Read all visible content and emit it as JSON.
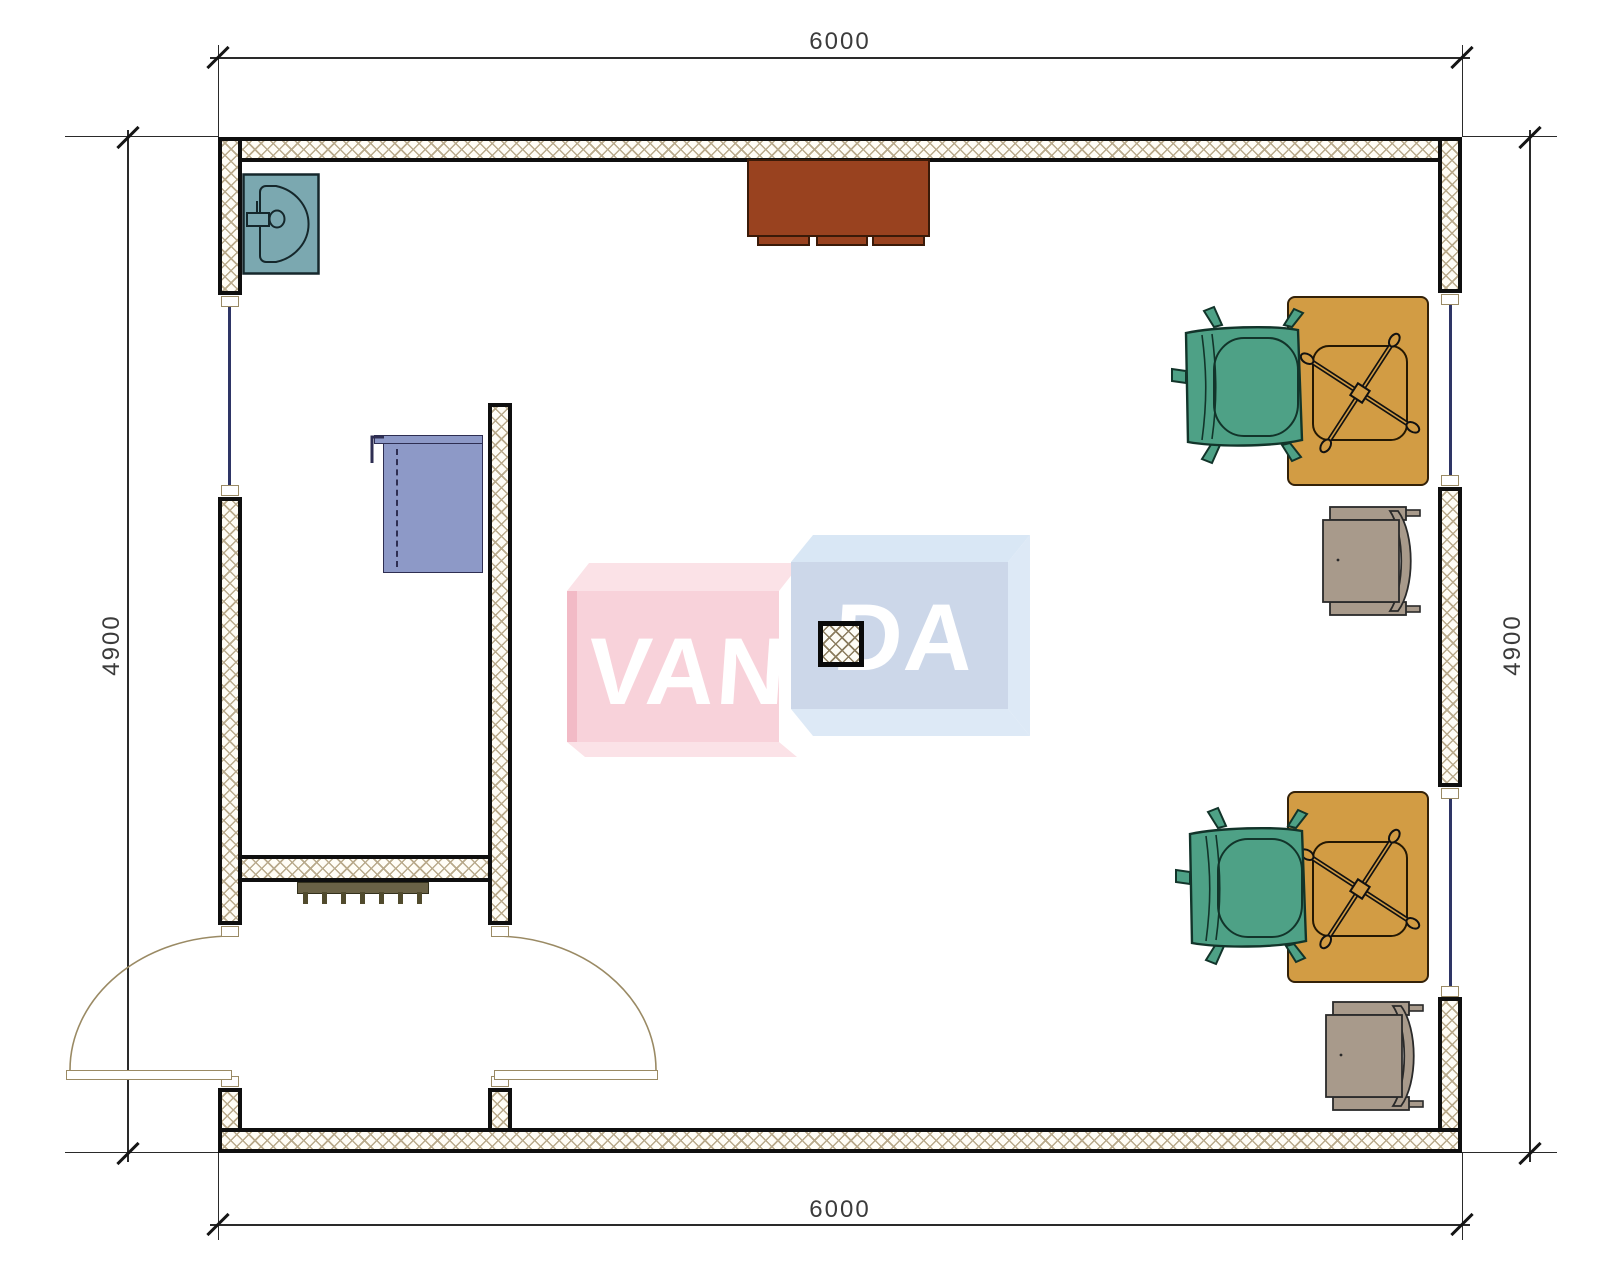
{
  "drawing": {
    "dimensions": {
      "top": "6000",
      "bottom": "6000",
      "left": "4900",
      "right": "4900"
    },
    "watermark": {
      "left": "VAN",
      "right": "DA"
    }
  },
  "colors": {
    "wall_line": "#0f0f0f",
    "wall_hatch": "#b9aa8c",
    "window": "#2e3566",
    "door_arc": "#9a8a64",
    "dim_text": "#3b3b3b",
    "sink": "#7ba8b0",
    "cabinet": "#99421f",
    "counter": "#8d99c7",
    "desk": "#d29c44",
    "armchair": "#4ea186",
    "side_chair": "#a89a8b",
    "radiator": "#6a6246",
    "logo_pink": "#f8d2da",
    "logo_pink_top": "#fbe2e7",
    "logo_blue": "#ccd7e9",
    "logo_blue_top": "#d9e7f5",
    "logo_blue_side": "#dde9f6"
  }
}
